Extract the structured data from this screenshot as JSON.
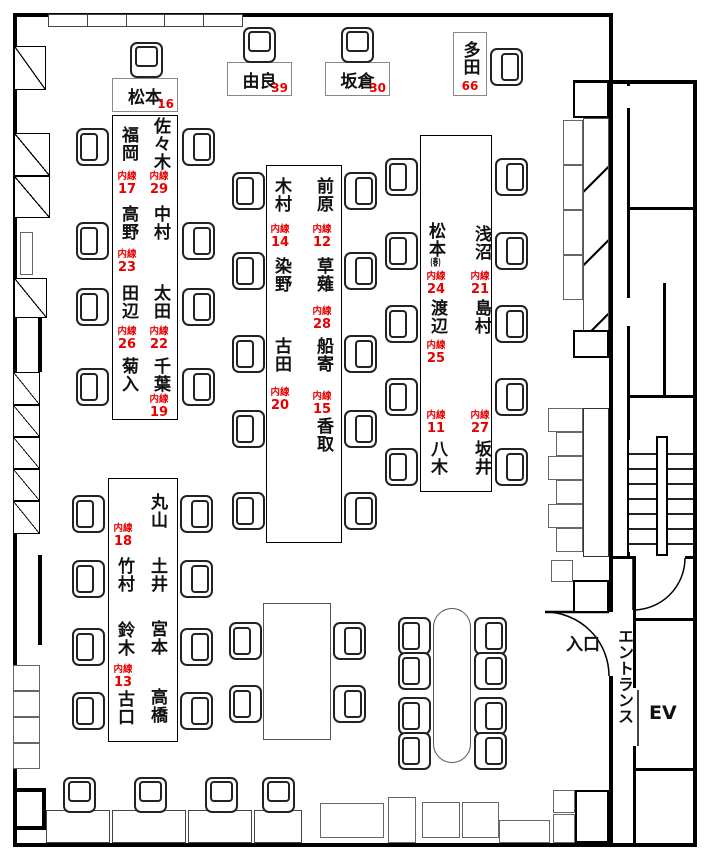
{
  "labels": {
    "ext_prefix": "内線",
    "entrance": "入口",
    "entrance_hall": "エントランス",
    "elevator": "EV"
  },
  "colors": {
    "ext_red": "#e60000",
    "wall": "#000000"
  },
  "top_desks": [
    {
      "name": "松本",
      "ext": "16"
    },
    {
      "name": "由良",
      "ext": "39"
    },
    {
      "name": "坂倉",
      "ext": "30"
    },
    {
      "name": "多田",
      "ext": "66"
    }
  ],
  "islands": {
    "a": {
      "left": [
        {
          "name": "福岡",
          "ext": "17"
        },
        {
          "name": "高野",
          "ext": "23"
        },
        {
          "name": "田辺",
          "ext": "26"
        },
        {
          "name": "菊入"
        }
      ],
      "right": [
        {
          "name": "佐々木",
          "ext": "29"
        },
        {
          "name": "中村"
        },
        {
          "name": "太田",
          "ext": "22"
        },
        {
          "name": "千葉",
          "ext": "19"
        }
      ]
    },
    "b": {
      "left": [
        {
          "name": "木村",
          "ext": "14"
        },
        {
          "name": "染野"
        },
        {
          "name": "古田",
          "ext": "20"
        }
      ],
      "right": [
        {
          "name": "前原",
          "ext": "12"
        },
        {
          "name": "草薙",
          "ext": "28"
        },
        {
          "name": "船寄",
          "ext": "15"
        },
        {
          "name": "香取"
        }
      ]
    },
    "c": {
      "left": [
        {
          "name": "松本",
          "suffix": "(春)",
          "ext": "24"
        },
        {
          "name": "渡辺",
          "ext": "25"
        },
        {
          "name": "八木",
          "ext": "11"
        }
      ],
      "right": [
        {
          "name": "浅沼",
          "ext": "21"
        },
        {
          "name": "島村"
        },
        {
          "name": "坂井",
          "ext": "27"
        }
      ]
    },
    "d": {
      "left": [
        {
          "ext": "18"
        },
        {
          "name": "竹村"
        },
        {
          "name": "鈴木",
          "ext": "13"
        },
        {
          "name": "古口"
        }
      ],
      "right": [
        {
          "name": "丸山"
        },
        {
          "name": "土井"
        },
        {
          "name": "宮本"
        },
        {
          "name": "高橋"
        }
      ]
    }
  }
}
